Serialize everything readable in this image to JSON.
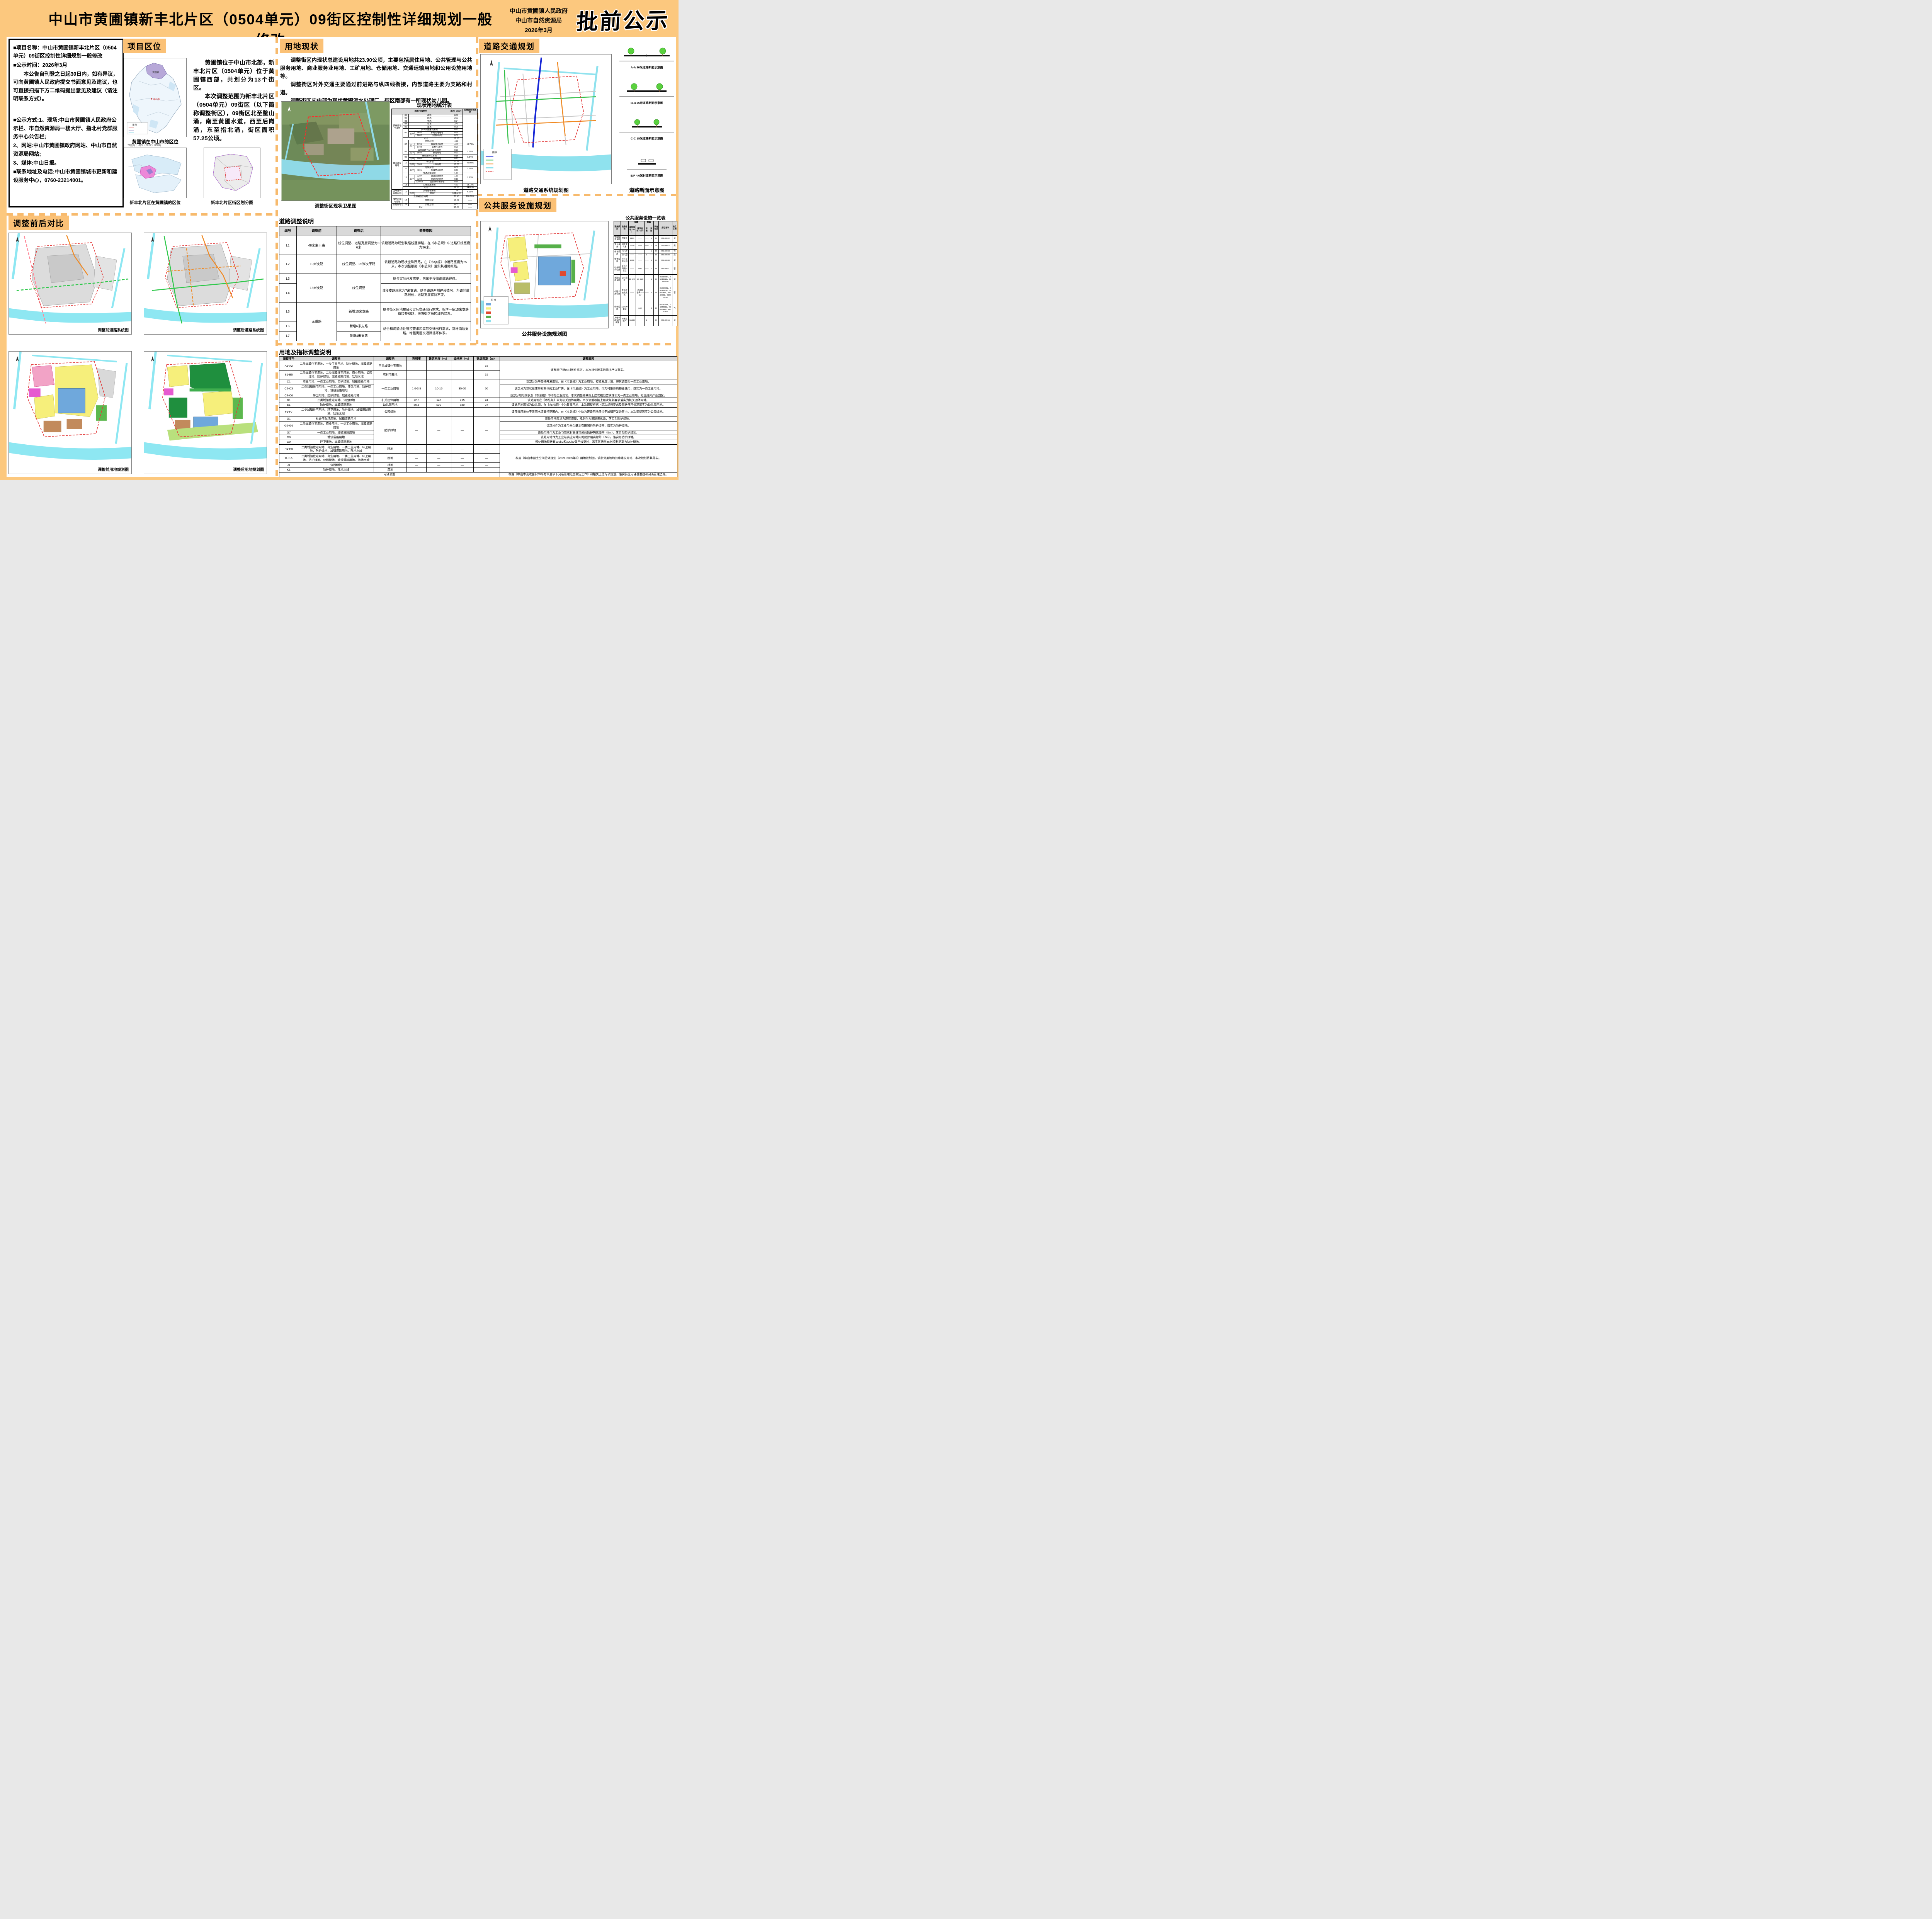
{
  "hd": {
    "title": "中山市黄圃镇新丰北片区（0504单元）09街区控制性详细规划一般修改",
    "gov": "中山市黄圃镇人民政府",
    "bureau": "中山市自然资源局",
    "date": "2026年3月",
    "stamp": "批前公示"
  },
  "sec": {
    "loc": "项目区位",
    "stx": "用地现状",
    "road": "道路交通规划",
    "fac": "公共服务设施规划",
    "cmp": "调整前后对比"
  },
  "info": {
    "p1": "■项目名称：中山市黄圃镇新丰北片区（0504单元）09街区控制性详细规划一般修改",
    "p2": "■公示时间：2026年3月",
    "p3": "本公告自刊登之日起30日内，如有异议，可向黄圃镇人民政府提交书面意见及建议，也可直接扫描下方二维码提出意见及建议（请注明联系方式）。",
    "m1": "■公示方式:1、现场:中山市黄圃镇人民政府公示栏、市自然资源局一楼大厅、指北村党群服务中心公告栏;",
    "m2": "2、网站:中山市黄圃镇政府网站、中山市自然资源局网站;",
    "m3": "3、媒体:中山日报。",
    "m4": "■联系地址及电话:中山市黄圃镇城市更新和建设服务中心，0760-23214001。"
  },
  "loc": {
    "p1": "黄圃镇位于中山市北部，新丰北片区（0504单元）位于黄圃镇西部，共划分为13个街区。",
    "p2": "本次调整范围为新丰北片区（0504单元）09街区（以下简称调整街区），09街区北至鳌山涌，南至黄圃水道，西至后岗涌，东至指北涌，街区面积57.25公顷。",
    "cap_city": "黄圃镇在中山市的区位",
    "cap_district": "新丰北片区在黄圃镇的区位",
    "cap_blocks": "新丰北片区街区划分图",
    "note": "审图号：粤S（2022）060号",
    "city_label": "黄圃镇",
    "city_name": "中山市",
    "legend": "图 例"
  },
  "stx": {
    "p1": "调整街区内现状总建设用地共23.90公顷，主要包括居住用地、公共管理与公共服务用地、商业服务业用地、工矿用地、仓储用地、交通运输用地和公用设施用地等。",
    "p2": "调整街区对外交通主要通过前进路与纵四线衔接，内部道路主要为支路和村道。",
    "p3": "调整街区内中部为现状黄圃污水处理厂，街区南部有一所现状幼儿园。",
    "cap_sat": "调整街区现状卫星图",
    "tbl": "现状用地统计表",
    "h0": "用地用海类型",
    "h1": "面积（hm²）",
    "h2": "占建设用地比例"
  },
  "st": {
    "r1": [
      "农林用地与湿地",
      "01",
      "耕地",
      "8.82",
      "——"
    ],
    "r2": [
      "02",
      "园地",
      "2.02"
    ],
    "r3": [
      "03",
      "林地",
      "0.24"
    ],
    "r4": [
      "04",
      "草地",
      "3.40"
    ],
    "r5": [
      "05",
      "湿地",
      "0.78"
    ],
    "r6": [
      "06",
      "农业设施建设用地",
      "0.77"
    ],
    "r7": [
      "其中",
      "0601",
      "乡村道路用地",
      "0.68"
    ],
    "r8": [
      "0602",
      "设施农用地",
      "0.08"
    ],
    "r9": [
      "小计",
      "16.03"
    ],
    "r10": [
      "城乡建设用地",
      "07",
      "居住用地",
      "4.72",
      "19.73%"
    ],
    "r11": [
      "其中",
      "0701",
      "城镇住宅用地",
      "4.43"
    ],
    "r12": [
      "0703",
      "农村宅基地",
      "0.29"
    ],
    "r13": [
      "08",
      "公共管理与公共服务用地",
      "0.31",
      "1.29%"
    ],
    "r14": [
      "其中",
      "0804",
      "教育用地",
      "0.31"
    ],
    "r15": [
      "09",
      "商业服务业用地",
      "0.15",
      "0.64%"
    ],
    "r16": [
      "其中",
      "0901",
      "商业用地",
      "0.15"
    ],
    "r17": [
      "10",
      "工矿用地",
      "10.78",
      "45.09%"
    ],
    "r18": [
      "其中",
      "1001",
      "工业用地",
      "10.78"
    ],
    "r19": [
      "11",
      "仓储用地",
      "0.50",
      "2.11%"
    ],
    "r20": [
      "其中",
      "1101",
      "仓储物流用地",
      "0.50"
    ],
    "r21": [
      "12",
      "交通运输用地",
      "1.87",
      "7.83%"
    ],
    "r22": [
      "其中",
      "1207",
      "城镇道路用地",
      "1.69"
    ],
    "r23": [
      "1208",
      "交通场站用地",
      "0.18"
    ],
    "r24": [
      "120803",
      "社会停车场用地",
      "0.18"
    ],
    "r25": [
      "13",
      "公用设施用地",
      "4.33",
      "18.12%"
    ],
    "r26": [
      "小计",
      "22.66",
      "94.81%"
    ],
    "r27": [
      "区域基础设施用地",
      "12",
      "交通运输用地",
      "1.24",
      "5.19%"
    ],
    "r28": [
      "其中",
      "1202",
      "公路用地",
      "1.24"
    ],
    "r29": [
      "规划建设总用地",
      "23.90",
      "100.00%"
    ],
    "r30": [
      "陆地水域与海域",
      "17",
      "陆地水域",
      "17.29",
      "——"
    ],
    "r31": [
      "其他用地",
      "23",
      "其他土地",
      "0.03",
      "——"
    ],
    "r32": [
      "合计",
      "57.25",
      "——"
    ]
  },
  "rdsec": {
    "title": "道路调整说明",
    "h": [
      "编号",
      "调整前",
      "调整后",
      "调整原因"
    ],
    "map_cap": "道路交通系统规划图",
    "xsec_cap": "道路断面示意图",
    "xs1": "A-A 36米道路断面示意图",
    "xs2": "B-B 25米道路断面示意图",
    "xs3": "C-C 15米道路断面示意图",
    "xs4": "E/F 4/6米村道断面示意图",
    "legend": "图 例"
  },
  "rd": {
    "r1": [
      "L1",
      "48米主干路",
      "线位调整、道路宽度调整为36米",
      "该段道路为规划联络线鳌柳路，在《市总规》中道路红线宽度为36米。"
    ],
    "r2": [
      "L2",
      "10米支路",
      "线位调整、25米次干路",
      "该段道路为现状宝珠西路，在《市总规》中道路宽度为25米，本次调整根据《市总规》落实其道路红线。"
    ],
    "r3": [
      "L3",
      "15米支路",
      "线位调整",
      "结合实际开发需要，向东平移微调道路线位。"
    ],
    "r4": [
      "L4",
      "该段支路现状为7米支路，结合道路两侧建设情况，为调其道路线位，道路宽度保持不变。"
    ],
    "r5": [
      "L5",
      "无道路",
      "新增15米支路",
      "结合街区用地布局和实际交通出行需求，新增一条15米支路衔接鳌柳路，增强街区与区域的联系。"
    ],
    "r6": [
      "L6",
      "新增6米支路",
      "结合和河涌退让管控要求和实际交通出行需求，新增涌边支路，增强街区交通微循环体系。"
    ],
    "r7": [
      "L7",
      "新增4米支路"
    ]
  },
  "ltsec": {
    "title": "用地及指标调整说明",
    "h": [
      "调整序号",
      "调整前",
      "调整后",
      "容积率",
      "建筑密度（%）",
      "绿地率（%）",
      "建筑限高（m）",
      "调整原因"
    ]
  },
  "lt": {
    "r1": [
      "A1-A2",
      "二类城镇住宅用地、一类工业用地、防护绿地、城镇道路用地",
      "三类城镇住宅用地",
      "—",
      "—",
      "—",
      "15",
      "该部分已建的村民住宅区，本次规划按实际情况予以落实。"
    ],
    "r2": [
      "B1-B5",
      "二类城镇住宅用地、二类城镇住宅用地、商业用地、公园绿地、防护绿地、城镇道路用地、陆地水域",
      "农村宅基地",
      "—",
      "—",
      "—",
      "15"
    ],
    "r3": [
      "C1",
      "商业用地、一类工业用地、防护绿地、城镇道路用地",
      "一类工业用地",
      "1.0-3.5",
      "10-15",
      "35-60",
      "50",
      "该部分为平整待开发用地，在《市总规》为工业用地，按镇发展计划，将其调整为一类工业用地。"
    ],
    "r4": [
      "C2-C3",
      "二类城镇住宅用地、一类工业用地、环卫用地、防护绿地、城镇道路用地",
      "该部分为现状已建的村集体的工业厂房，在《市总规》为工业用地，作为村集体的物业使用，落实为一类工业用地。"
    ],
    "r5": [
      "C4-C6",
      "环卫用地、防护绿地、城镇道路用地",
      "该部分用地现状及《市总规》中均为工业用地，本次调整将其按上层次规划要求落实为一类工业用地，打造成片产业园区。"
    ],
    "r6": [
      "D1",
      "二类城镇住宅用地、公园绿地",
      "机关团体用地",
      "≤2.0",
      "≤45",
      "≥15",
      "24",
      "该处用地在《市总规》中为机关团体用地，本次调整根据上层次规划要求落实为机关团体用地。"
    ],
    "r7": [
      "E1",
      "防护绿地、城镇道路用地",
      "幼儿园用地",
      "≤0.8",
      "≤30",
      "≥30",
      "24",
      "该处用地现状为幼儿园，在《市总规》中为教育用地，本次调整根据上层次规划要求及现状使用情况落实为幼儿园用地。"
    ],
    "r8": [
      "F1-F7",
      "二类城镇住宅用地、环卫用地、防护绿地、城镇道路用地、陆地水域",
      "公园绿地",
      "—",
      "—",
      "—",
      "—",
      "该部分用地位于黄圃水道管控范围内，在《市总规》中均为建设用地且位于城镇开发边界内，本次调整落实为公园绿地。"
    ],
    "r9": [
      "G1",
      "社会停车场用地、城镇道路用地",
      "防护绿地",
      "—",
      "—",
      "—",
      "—",
      "该处用地现状为高压塔基，规划作为道路渠化岛，落实为防护绿地。"
    ],
    "r10": [
      "G2-G6",
      "二类城镇住宅用地、商业用地、一类工业用地、城镇道路用地",
      "该部分作为工业与永久基本农田间的防护绿带，落实为防护绿地。"
    ],
    "r11": [
      "G7",
      "一类工业用地、城镇道路用地",
      "该处用地作为工业与现状村民住宅间的防护隔离绿带（5m），落实为防护绿地。"
    ],
    "r12": [
      "G8",
      "城镇道路用地",
      "该处用地作为工业与商业用地间的防护隔离绿带（5m），落实为防护绿地。"
    ],
    "r13": [
      "G9",
      "环卫用地、城镇道路用地",
      "该处用地现状有110kV和220kV架空线穿过，落实其两侧45米控制距离为防护绿地。"
    ],
    "r14": [
      "H1-H8",
      "二类城镇住宅用地、商业用地、一类工业用地、环卫用地、防护绿地、城镇道路用地、陆地水域",
      "耕地",
      "—",
      "—",
      "—",
      "—",
      "根据《中山市国土空间总体规划（2021-2035年）》用地规划图，该部分用地均为非建设用地，本次规划将其落实。"
    ],
    "r15": [
      "I1-I15",
      "二类城镇住宅用地、商业用地、一类工业用地、环卫用地、防护绿地、公园绿地、城镇道路用地、陆地水域",
      "园地",
      "—",
      "—",
      "—",
      "—"
    ],
    "r16": [
      "J1",
      "公园绿地",
      "林地",
      "—",
      "—",
      "—",
      "—"
    ],
    "r17": [
      "K1",
      "防护绿地、陆地水域",
      "湿地",
      "—",
      "—",
      "—",
      "—"
    ],
    "r18": [
      "河涌调整",
      "根据《中山市流域面积50平方公里以下河道管理范围划定工作》和相关上位专项规划，落实街区河涌基准线和河涌管理边界。"
    ]
  },
  "fs": {
    "tbl": "公共服务设施一览表",
    "map_cap": "公共服务设施规划图",
    "legend": "图 例",
    "h1": [
      "设施类别",
      "设施名称",
      "规模",
      "数量",
      "所在街区",
      "所在地块",
      "独立占地"
    ],
    "h2": [
      "用地面积（m²）",
      "建筑面积（m²）",
      "现状",
      "规划"
    ]
  },
  "ft": {
    "r1": [
      "管理服务设施",
      "村委会",
      "3161",
      "——",
      "——",
      "1",
      "09",
      "05040922",
      "是"
    ],
    "r2": [
      "文化设施",
      "邻里文化家",
      "≥200",
      "——",
      "——",
      "1",
      "09",
      "05040922",
      "是"
    ],
    "r3": [
      "教育设施",
      "托儿所",
      "——",
      "——",
      "——",
      "1",
      "09",
      "05040903",
      "否"
    ],
    "r4": [
      "幼儿园",
      "——",
      "——",
      "1",
      "——",
      "09",
      "05040920",
      "是"
    ],
    "r5": [
      "体育设施",
      "社区文体公园",
      "≥350",
      "——",
      "——",
      "1",
      "09",
      "05040930",
      "是"
    ],
    "r6": [
      "社会福利设施",
      "老人日间照料中心",
      "——",
      "≥350",
      "——",
      "1",
      "09",
      "05040921",
      "否"
    ],
    "r7": [
      "市政公用设施",
      "公共厕所",
      "80~170",
      "50~120",
      "——",
      "1",
      "09",
      "05040904、05040916、05040930",
      "是"
    ],
    "r8": [
      "小区公用设施",
      "生活垃圾收集点",
      "——",
      "垃圾容器间≥10m²",
      "——",
      "2",
      "09",
      "05040902、05040904、05040916、05040921、05040930",
      "否"
    ],
    "r9": [
      "供电设施",
      "10kV开关站",
      "——",
      "≥40",
      "——",
      "4",
      "09",
      "05040908、05040911、05040916、05040925",
      "否"
    ],
    "r10": [
      "其他市政公用设施",
      "污水处理厂",
      "56439",
      "——",
      "1",
      "——",
      "09",
      "05040916",
      "是"
    ]
  },
  "cmp": {
    "c1": "调整前道路系统图",
    "c2": "调整后道路系统图",
    "c3": "调整前用地规划图",
    "c4": "调整后用地规划图"
  }
}
